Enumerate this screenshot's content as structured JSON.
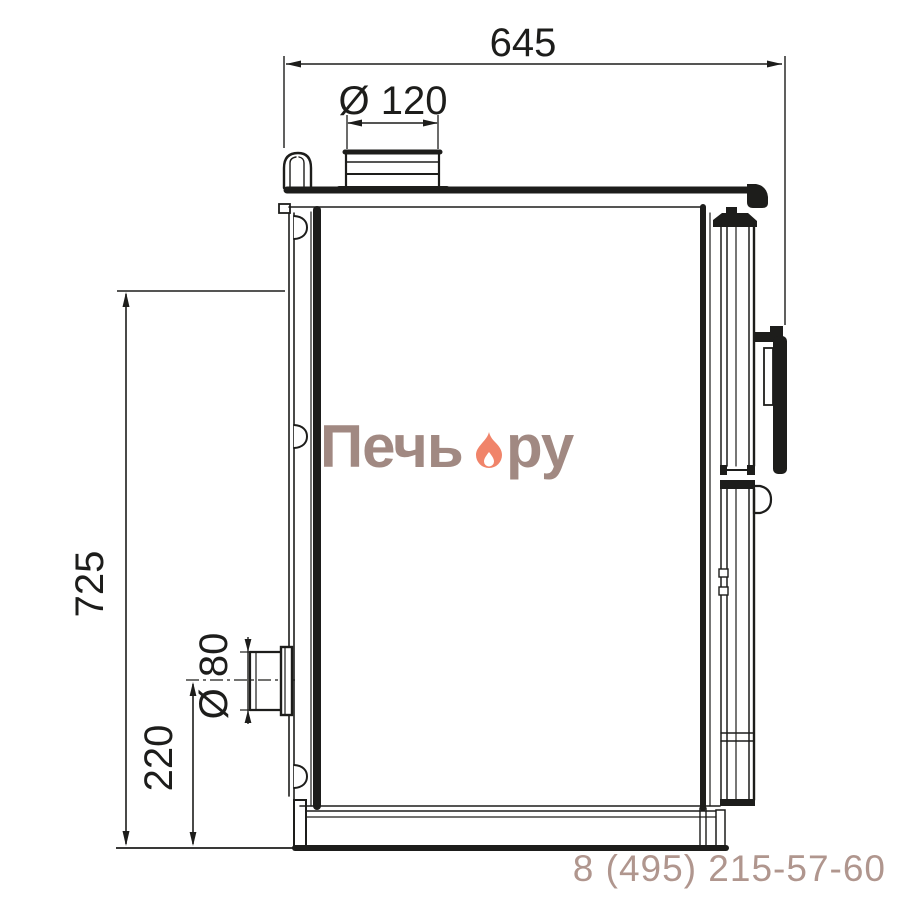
{
  "canvas": {
    "background": "#ffffff",
    "line_color": "#1d1d1b"
  },
  "drawing": {
    "view": "stove-side-view-technical-drawing"
  },
  "dimensions": {
    "top_width": {
      "label": "645"
    },
    "flue_diameter": {
      "label": "Ø 120"
    },
    "left_height": {
      "label": "725"
    },
    "outlet_diameter": {
      "label": "Ø 80"
    },
    "outlet_height": {
      "label": "220"
    }
  },
  "watermark": {
    "brand_prefix": "Печь",
    "brand_suffix": "ру",
    "text_color": "#9a8078",
    "flame_color": "#f0846a"
  },
  "footer": {
    "phone": "8 (495) 215-57-60",
    "phone_color": "#b0968e"
  }
}
